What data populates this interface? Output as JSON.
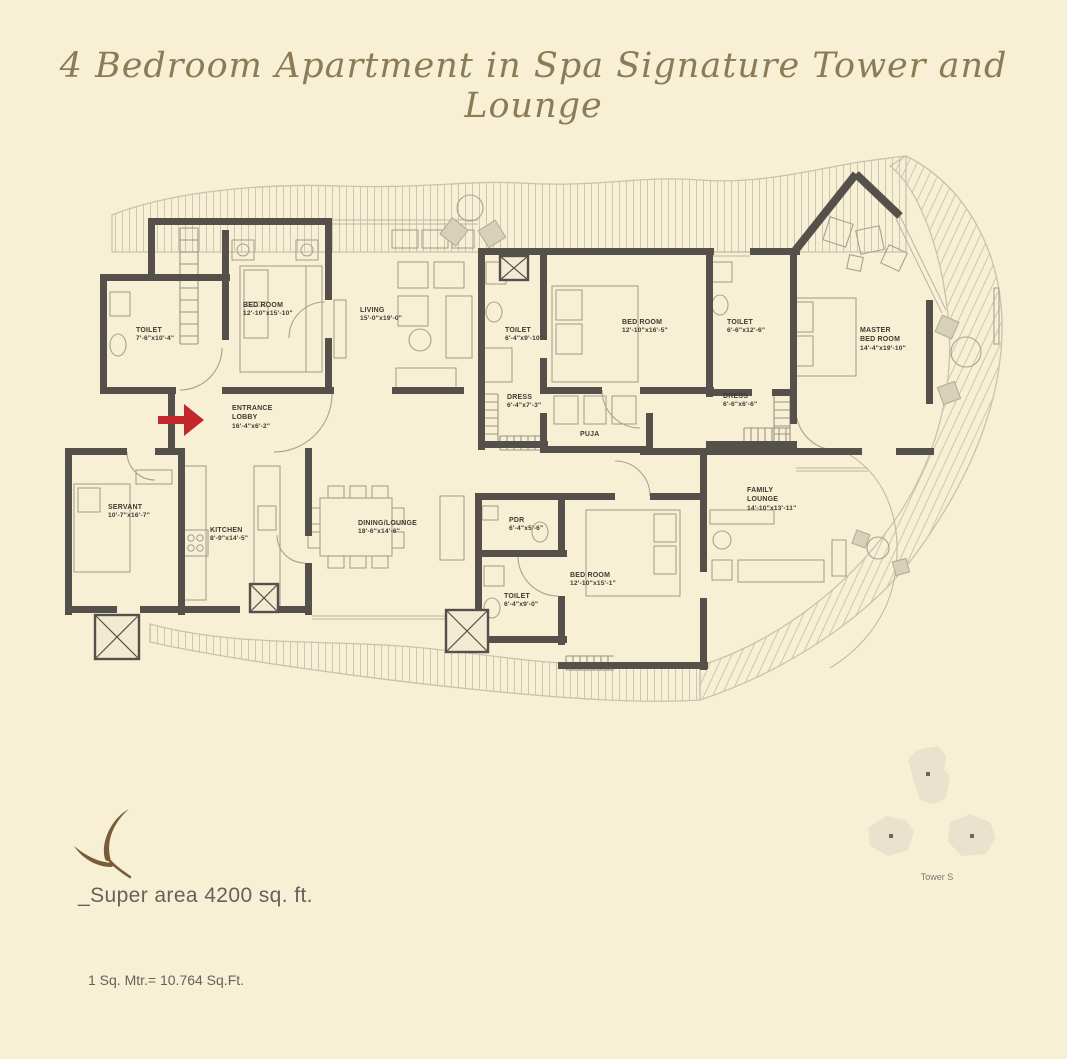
{
  "title": "4 Bedroom Apartment in Spa Signature Tower and Lounge",
  "rooms": [
    {
      "name": "TOILET",
      "dims": "7'-6\"x10'-4\""
    },
    {
      "name": "BED ROOM",
      "dims": "12'-10\"x15'-10\""
    },
    {
      "name": "LIVING",
      "dims": "15'-0\"x19'-0\""
    },
    {
      "name": "TOILET",
      "dims": "6'-4\"x9'-10\""
    },
    {
      "name": "BED ROOM",
      "dims": "12'-10\"x16'-5\""
    },
    {
      "name": "TOILET",
      "dims": "6'-6\"x12'-6\""
    },
    {
      "name": "MASTER BED ROOM",
      "dims": "14'-4\"x19'-10\""
    },
    {
      "name": "ENTRANCE LOBBY",
      "dims": "16'-4\"x6'-2\""
    },
    {
      "name": "DRESS",
      "dims": "6'-4\"x7'-3\""
    },
    {
      "name": "PUJA",
      "dims": ""
    },
    {
      "name": "DRESS",
      "dims": "6'-6\"x6'-6\""
    },
    {
      "name": "SERVANT",
      "dims": "10'-7\"x16'-7\""
    },
    {
      "name": "KITCHEN",
      "dims": "8'-9\"x14'-5\""
    },
    {
      "name": "DINING/LOUNGE",
      "dims": "18'-6\"x14'-6\""
    },
    {
      "name": "PDR",
      "dims": "6'-4\"x5'-6\""
    },
    {
      "name": "BED ROOM",
      "dims": "12'-10\"x15'-1\""
    },
    {
      "name": "FAMILY LOUNGE",
      "dims": "14'-10\"x13'-11\""
    },
    {
      "name": "TOILET",
      "dims": "6'-4\"x9'-0\""
    }
  ],
  "footer": {
    "super_area": "_Super area 4200 sq. ft.",
    "conversion": "1 Sq. Mtr.= 10.764 Sq.Ft."
  },
  "tower": {
    "label": "Tower S"
  },
  "colors": {
    "background": "#f7f0d5",
    "wall": "#56504a",
    "line": "#a9a28e",
    "hatch": "#cdc6b2",
    "title": "#8b7b56",
    "entrance_arrow": "#c3272b",
    "logo": "#7a5b38",
    "tower_fill": "#e9e2cd"
  }
}
